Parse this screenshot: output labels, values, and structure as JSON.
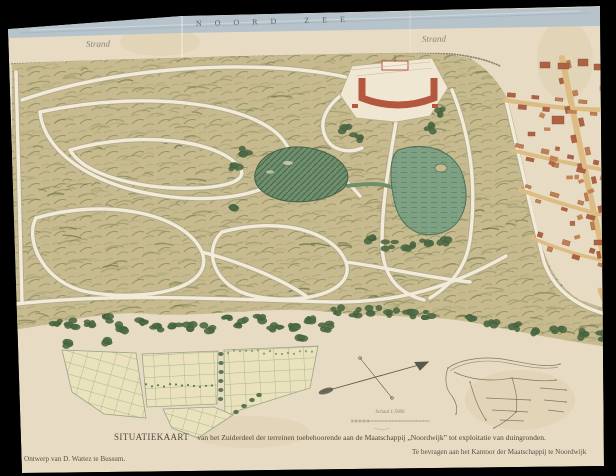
{
  "map": {
    "sea_label": "NOORD ZEE",
    "beach_labels": [
      "Strand",
      "Strand"
    ],
    "scale_label": "Schaal 1:5000",
    "title": {
      "lead": "SITUATIEKAART",
      "rest": "van het Zuiderdeel der terreinen toebehoorende aan de Maatschappij „Noordwijk” tot exploitatie van duingronden."
    },
    "credits": {
      "left": "Ontwerp van D. Wattez te Bussum.",
      "right": "Te bevragen aan het Kantoor der Maatschappij te Noordwijk"
    }
  },
  "colors": {
    "frame": "#000000",
    "paper": "#e7dcc3",
    "sea": "#b7c3cb",
    "terrain": "#c6ba8e",
    "terrain_dark": "#66703f",
    "terrain_mid": "#8f9160",
    "path": "#f2ebd7",
    "lake": "#6f8f6c",
    "lake2": "#7fa183",
    "lake_dark": "#3f5a45",
    "building": "#c08052",
    "building_dark": "#ad6243",
    "hotel_red": "#b4573f",
    "street": "#dcbc82",
    "parcel": "#e9e2bd",
    "parcel_line": "#9aa487",
    "tree": "#4c6a44",
    "ink": "#4a463c"
  }
}
